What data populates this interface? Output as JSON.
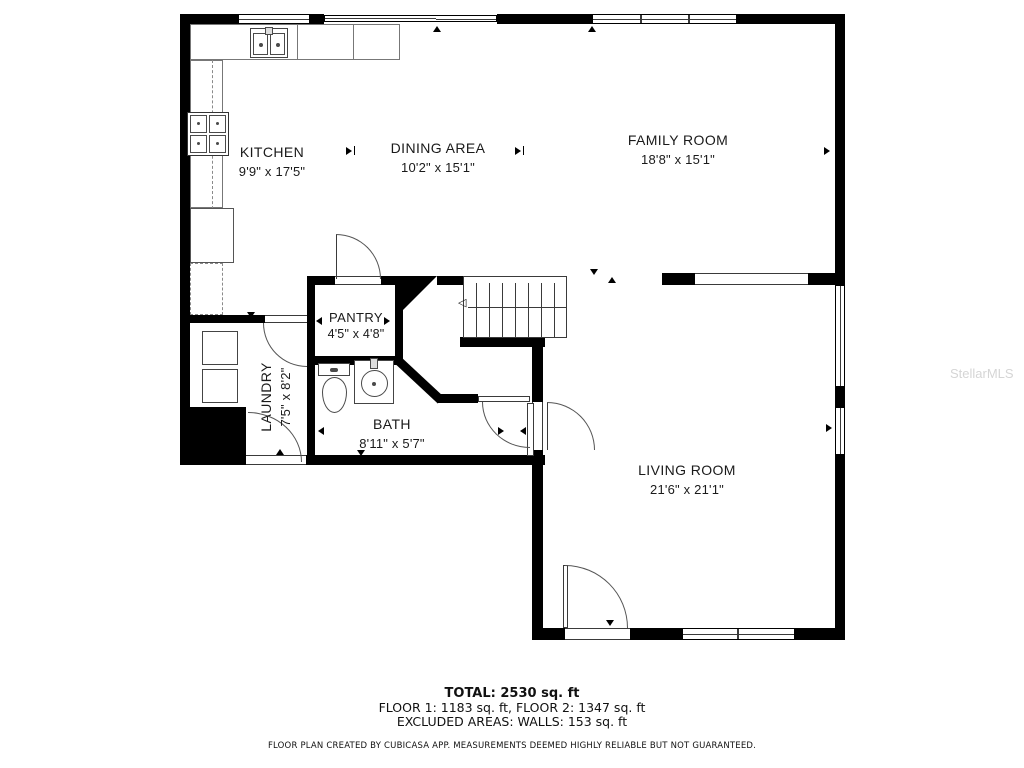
{
  "watermark": "StellarMLS",
  "rooms": [
    {
      "name": "KITCHEN",
      "dims": "9'9\" x 17'5\""
    },
    {
      "name": "DINING AREA",
      "dims": "10'2\" x 15'1\""
    },
    {
      "name": "FAMILY ROOM",
      "dims": "18'8\" x 15'1\""
    },
    {
      "name": "PANTRY",
      "dims": "4'5\" x 4'8\""
    },
    {
      "name": "LAUNDRY",
      "dims": "7'5\" x 8'2\""
    },
    {
      "name": "BATH",
      "dims": "8'11\" x 5'7\""
    },
    {
      "name": "LIVING ROOM",
      "dims": "21'6\" x 21'1\""
    }
  ],
  "stairs_arrow": "◁",
  "footer": {
    "total": "TOTAL: 2530 sq. ft",
    "floors": "FLOOR 1: 1183 sq. ft, FLOOR 2: 1347 sq. ft",
    "excluded": "EXCLUDED AREAS: WALLS: 153 sq. ft",
    "disclaimer": "FLOOR PLAN CREATED BY CUBICASA APP. MEASUREMENTS DEEMED HIGHLY RELIABLE BUT NOT GUARANTEED."
  },
  "colors": {
    "wall": "#000000",
    "text": "#1a1a1a",
    "watermark": "#d5d5d5"
  }
}
